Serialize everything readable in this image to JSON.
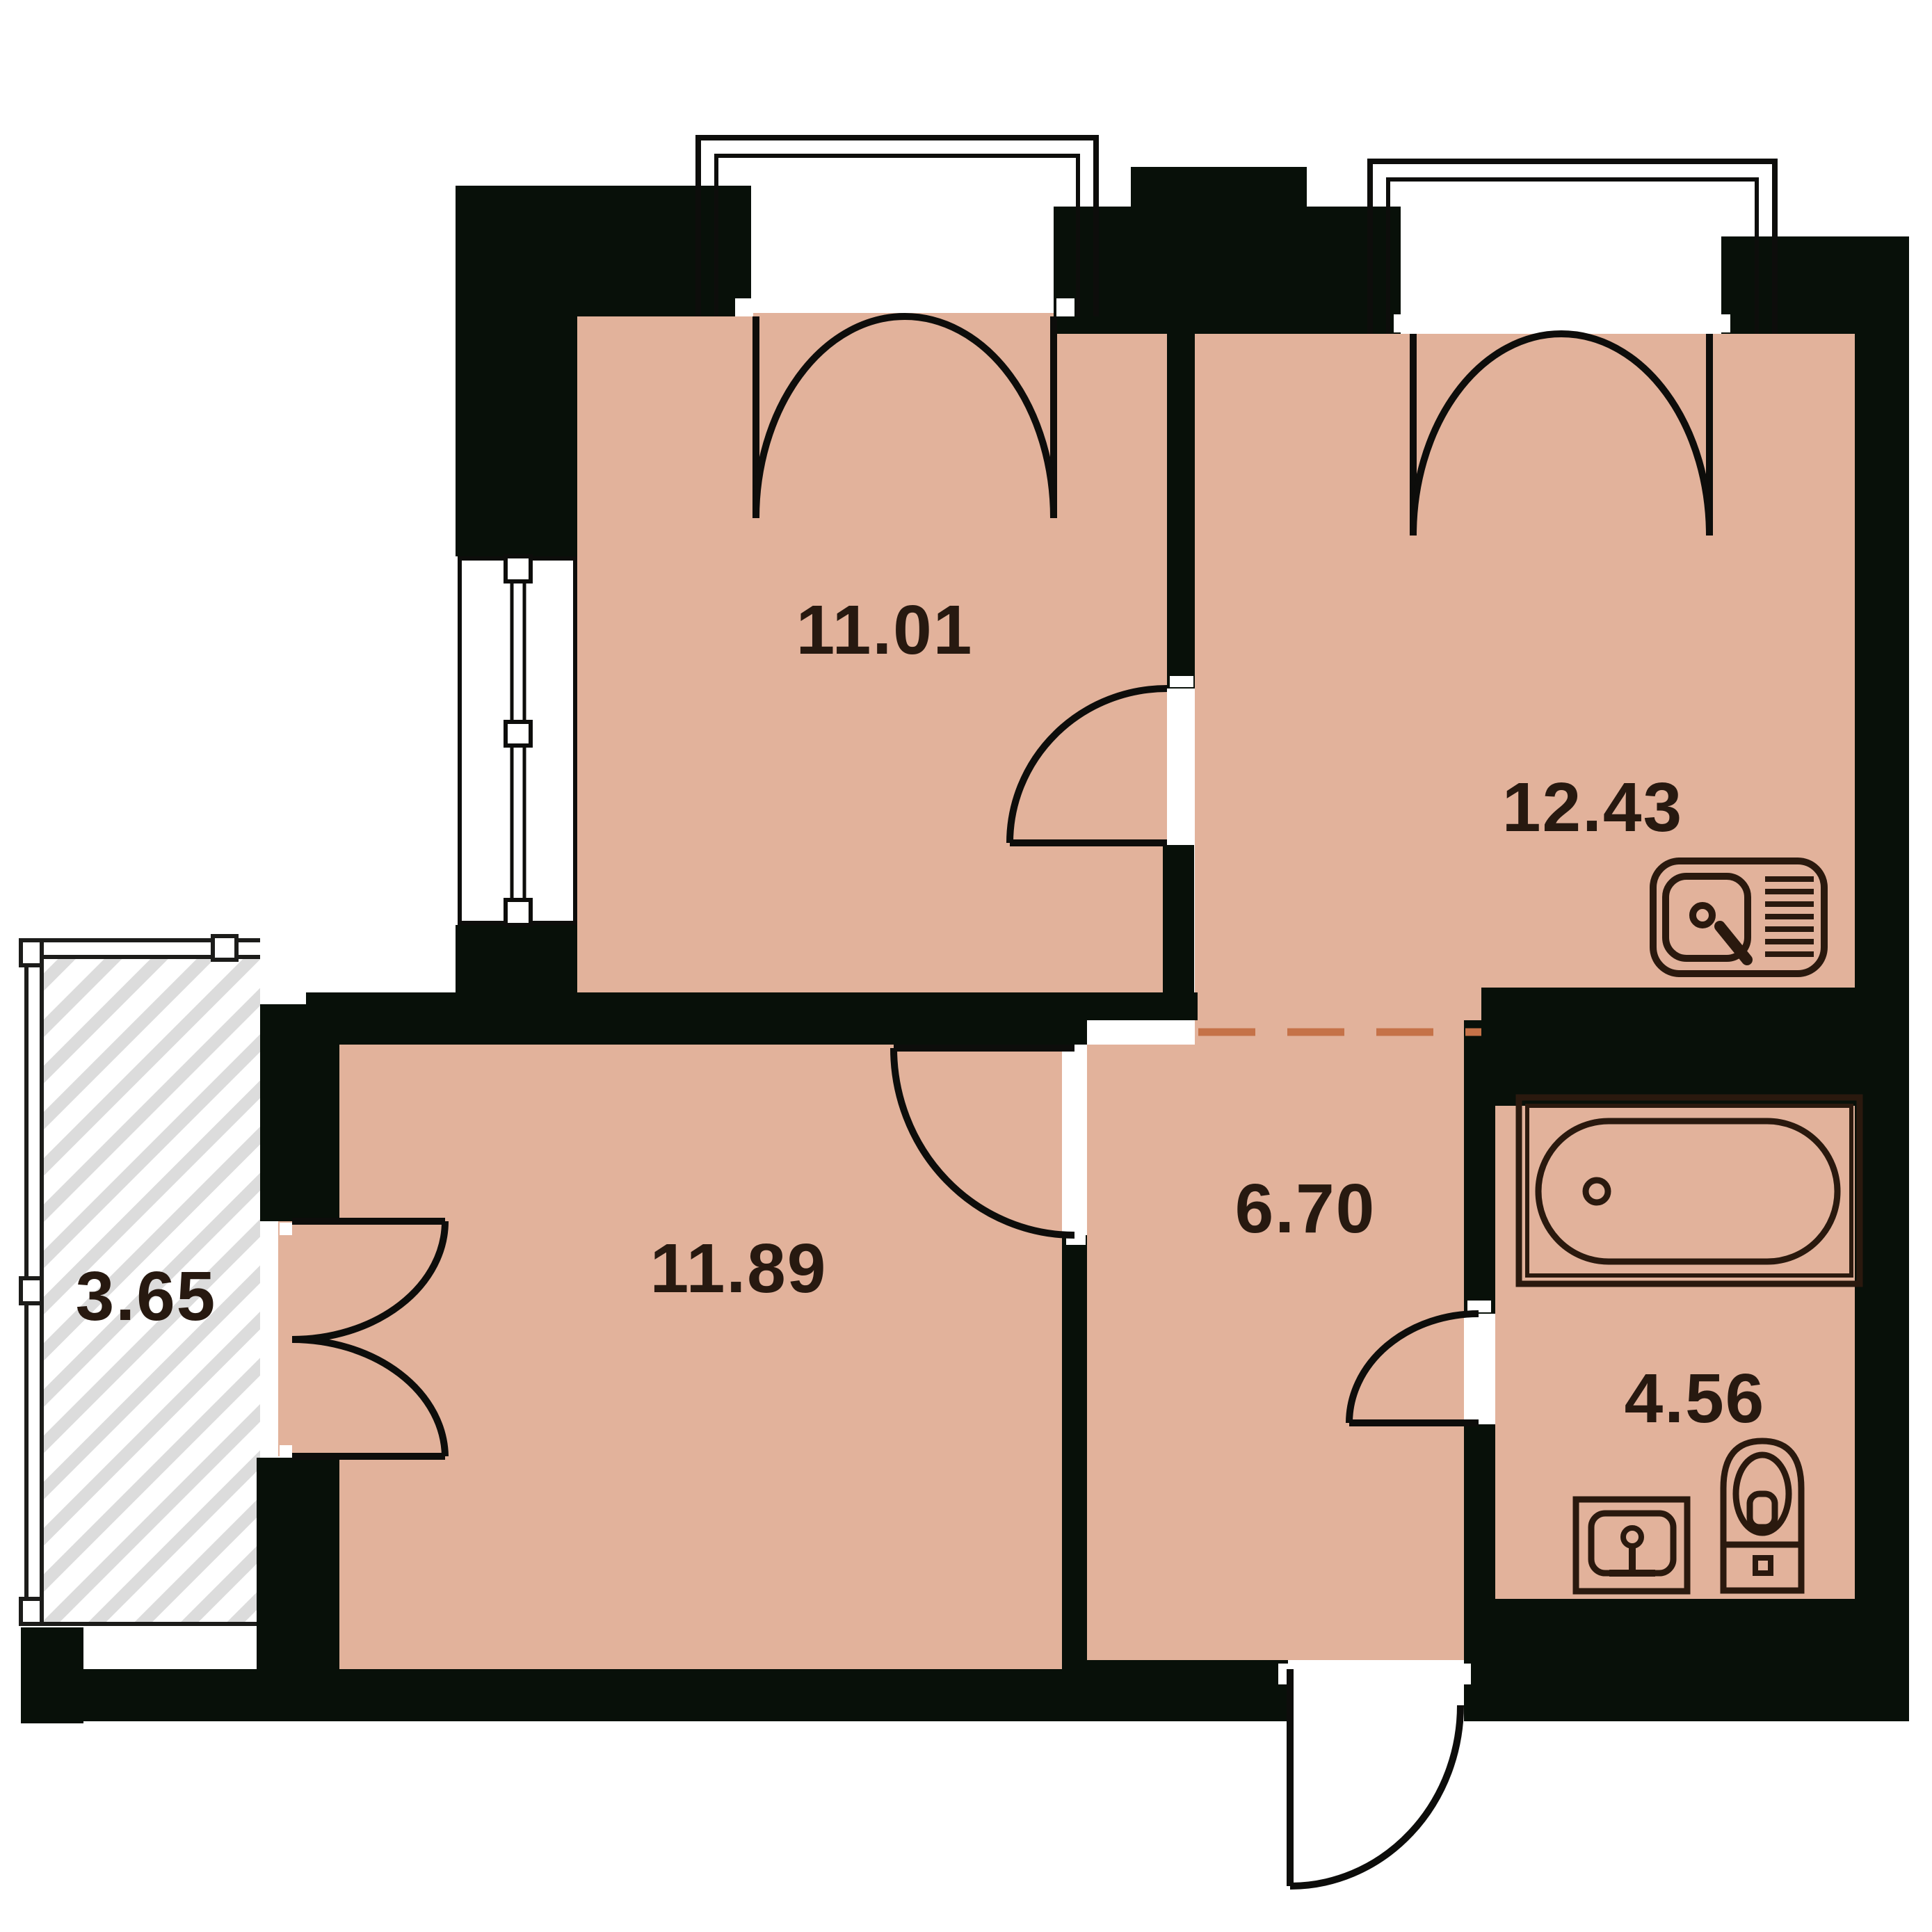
{
  "document": {
    "type": "apartment-floor-plan",
    "units": "square-meters-implied"
  },
  "colors": {
    "floor_fill": "#e2b29b",
    "wall_fill": "#081009",
    "outline": "#1c120b",
    "fixture_line": "#2a190e",
    "virtual_boundary_dash": "#c57248",
    "balcony_hatch": "#dcdcdc",
    "label_text": "#271910",
    "background": "#ffffff"
  },
  "rooms": [
    {
      "id": "room-top-left",
      "area": "11.01"
    },
    {
      "id": "kitchen-living",
      "area": "12.43"
    },
    {
      "id": "room-bottom-left",
      "area": "11.89"
    },
    {
      "id": "hallway",
      "area": "6.70"
    },
    {
      "id": "bathroom",
      "area": "4.56"
    },
    {
      "id": "balcony",
      "area": "3.65"
    }
  ],
  "fixtures": [
    {
      "icon": "kitchen-sink-icon",
      "location": "kitchen-living"
    },
    {
      "icon": "bathtub-icon",
      "location": "bathroom"
    },
    {
      "icon": "washbasin-icon",
      "location": "bathroom"
    },
    {
      "icon": "toilet-icon",
      "location": "bathroom"
    }
  ],
  "features": [
    "double-french-door-room-top-left",
    "double-french-door-kitchen-living",
    "balcony-double-door",
    "interior-door-room-top-left-to-kitchen",
    "interior-door-hallway-to-room-bottom-left",
    "interior-door-hallway-to-bathroom",
    "entrance-door-bottom",
    "window-left-wall",
    "dashed-open-boundary-kitchen-hallway"
  ]
}
